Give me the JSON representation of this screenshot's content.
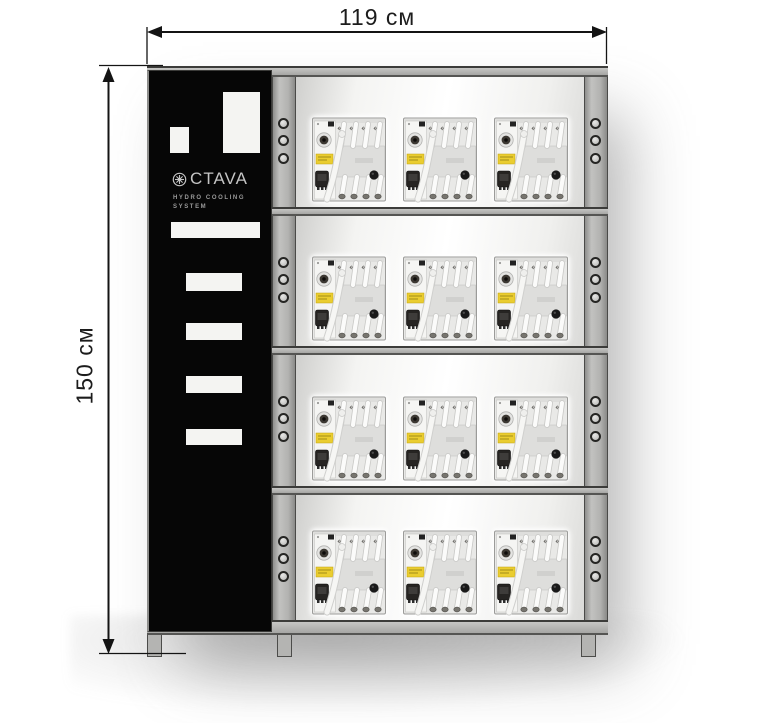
{
  "diagram": {
    "type": "product-dimension-diagram",
    "subject": "hydro cooling mining rack"
  },
  "dimensions": {
    "width_label": "119 см",
    "height_label": "150 см"
  },
  "brand": {
    "logo_icon": "octava-gear-icon",
    "logo_text": "CTAVA",
    "subtitle_line1": "HYDRO COOLING",
    "subtitle_line2": "SYSTEM"
  },
  "rack": {
    "shelf_rows": 4,
    "units_per_row": 3,
    "total_units": 12,
    "holes_per_post_section": 3,
    "legs": 3
  },
  "colors": {
    "frame_gray": "#b2b2b0",
    "frame_edge": "#3c3c3a",
    "panel_black": "#060606",
    "dimension_line": "#141414",
    "unit_body": "#e9e9e7",
    "sticker_yellow": "#eacd30",
    "background": "#ffffff"
  }
}
